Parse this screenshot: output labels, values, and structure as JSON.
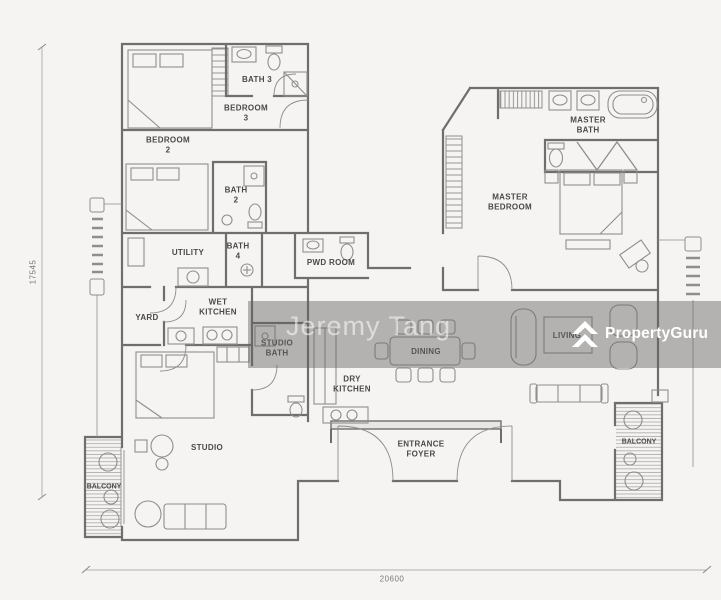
{
  "image_type": "floor-plan",
  "watermark": {
    "agent": "Jeremy Tang",
    "brand": "PropertyGuru"
  },
  "icons": {
    "brand_logo": "propertyguru-double-chevron-icon"
  },
  "dimensions": {
    "height_mm": "17545",
    "width_mm": "20600"
  },
  "rooms": {
    "bath3": {
      "l1": "BATH 3"
    },
    "bedroom3": {
      "l1": "BEDROOM",
      "l2": "3"
    },
    "bedroom2": {
      "l1": "BEDROOM",
      "l2": "2"
    },
    "bath2": {
      "l1": "BATH",
      "l2": "2"
    },
    "utility": {
      "l1": "UTILITY"
    },
    "bath4": {
      "l1": "BATH",
      "l2": "4"
    },
    "pwd": {
      "l1": "PWD ROOM"
    },
    "yard": {
      "l1": "YARD"
    },
    "wet_kitchen": {
      "l1": "WET",
      "l2": "KITCHEN"
    },
    "studio_bath": {
      "l1": "STUDIO",
      "l2": "BATH"
    },
    "master_bath": {
      "l1": "MASTER",
      "l2": "BATH"
    },
    "master_bedroom": {
      "l1": "MASTER",
      "l2": "BEDROOM"
    },
    "dining": {
      "l1": "DINING"
    },
    "dry_kitchen": {
      "l1": "DRY",
      "l2": "KITCHEN"
    },
    "living": {
      "l1": "LIVING"
    },
    "studio": {
      "l1": "STUDIO"
    },
    "balcony_left": {
      "l1": "BALCONY"
    },
    "balcony_right": {
      "l1": "BALCONY"
    },
    "entrance_foyer": {
      "l1": "ENTRANCE",
      "l2": "FOYER"
    }
  },
  "colors": {
    "background": "#f5f4f2",
    "walls": "#6f6e6c",
    "furniture": "#8f8e8c",
    "watermark_band": "rgba(103,101,98,0.46)",
    "watermark_text": "#ffffff",
    "label_text": "#4a4947"
  }
}
